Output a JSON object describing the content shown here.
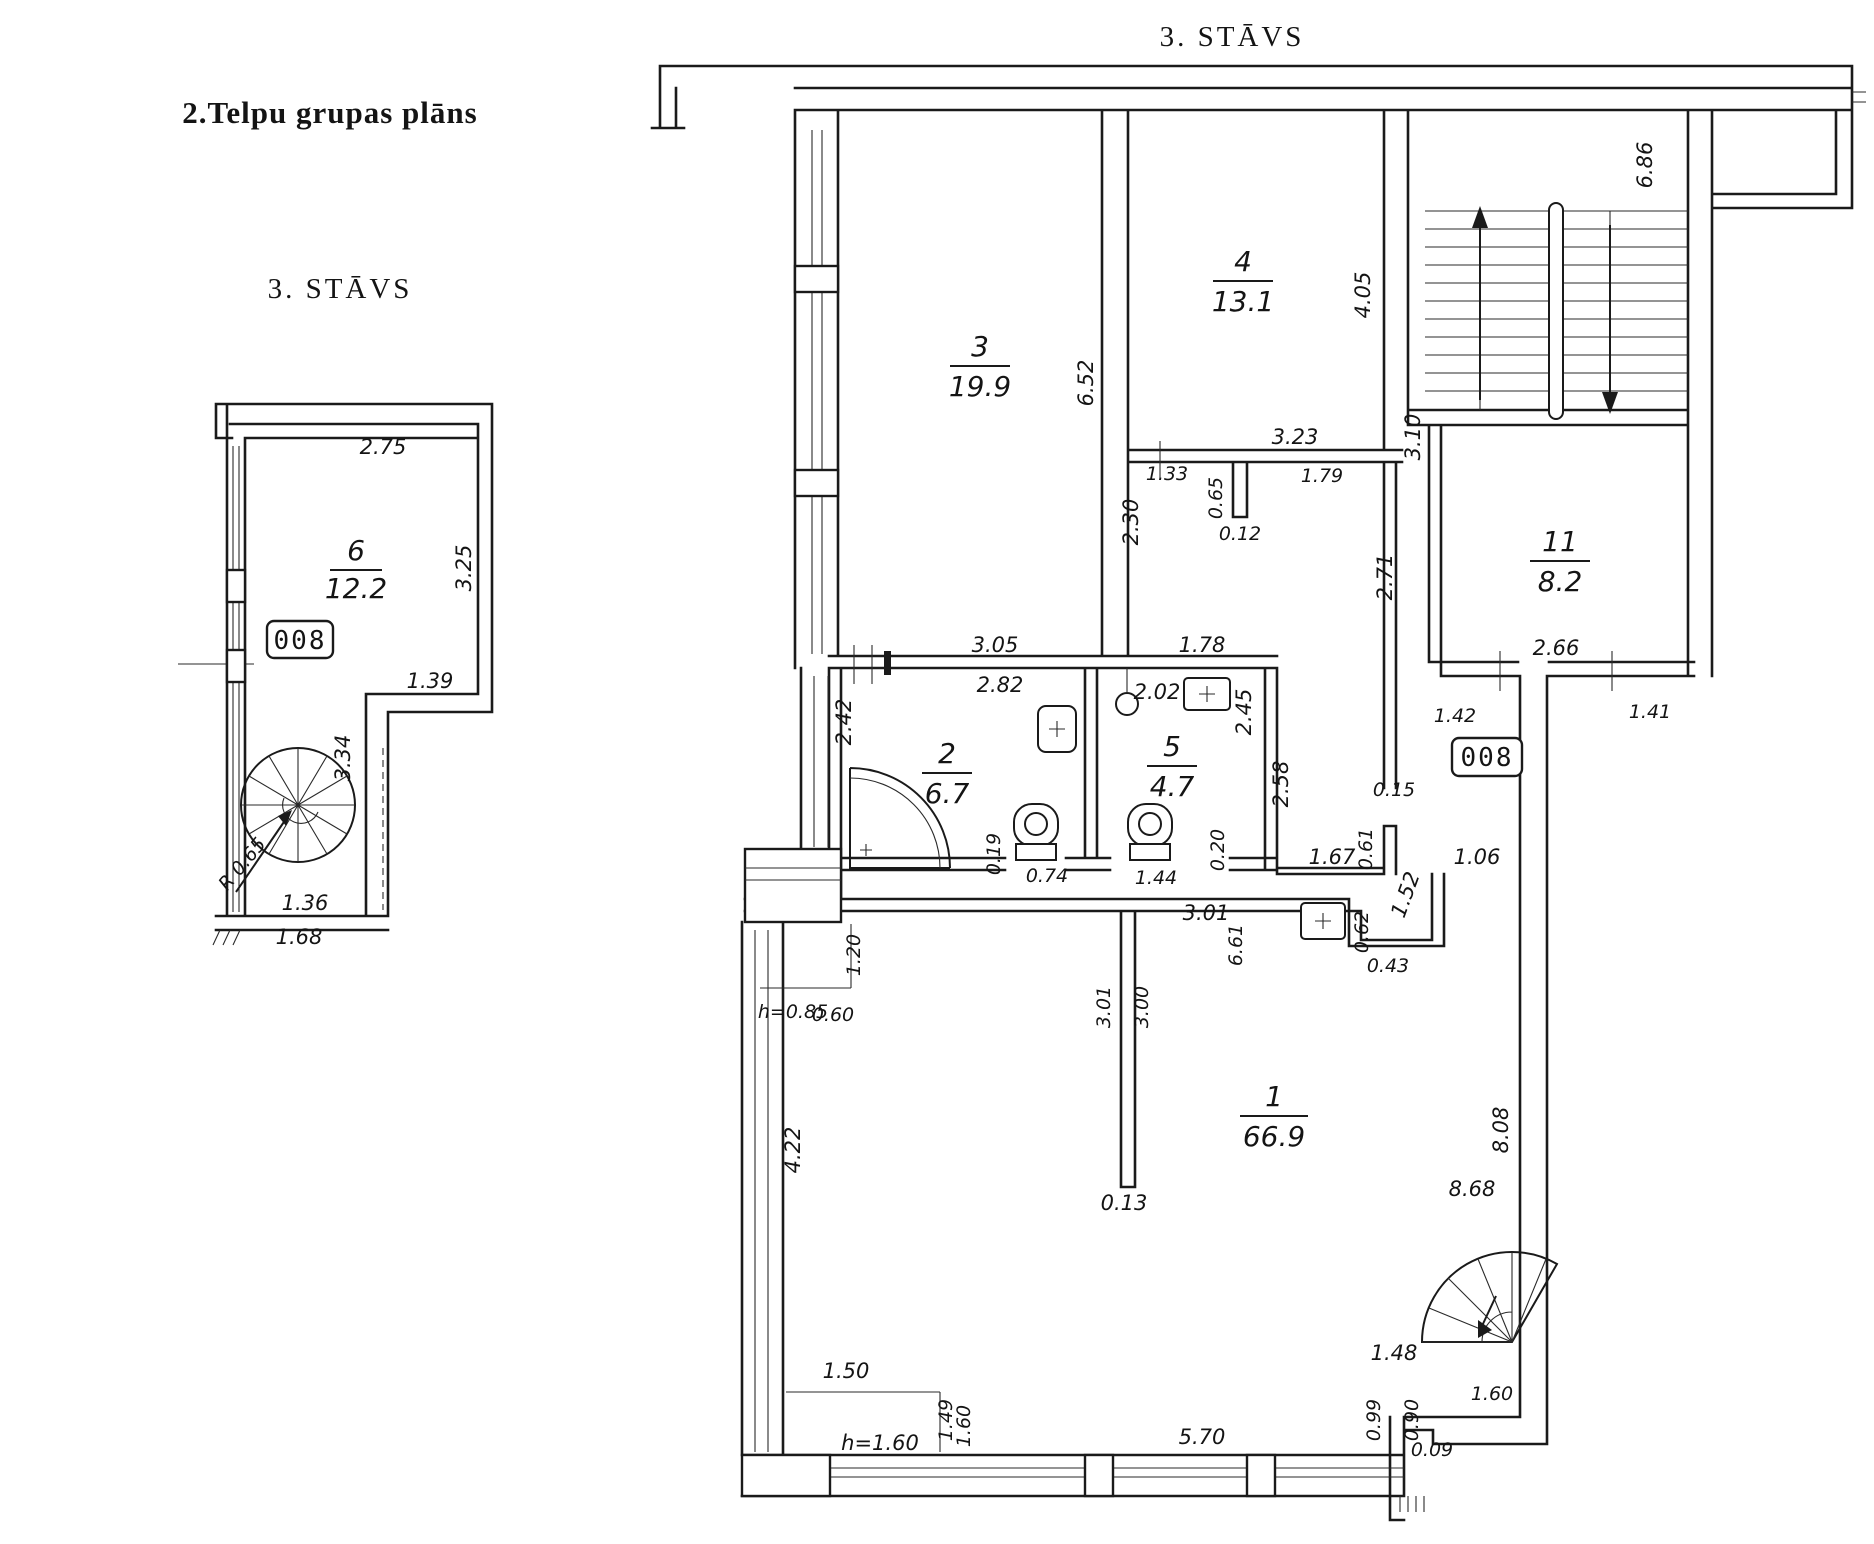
{
  "page_title": "2.Telpu grupas plāns",
  "left_plan": {
    "floor_label": "3. STĀVS",
    "unit_label": "008",
    "room": {
      "number": "6",
      "area": "12.2"
    },
    "dims": {
      "top_width": "2.75",
      "right_height": "3.25",
      "niche_width": "1.39",
      "stair_zone_height": "3.34",
      "stair_zone_width": "1.36",
      "bottom_width": "1.68",
      "stair_radius": "R 0.65"
    }
  },
  "main_plan": {
    "floor_label": "3. STĀVS",
    "unit_label": "008",
    "rooms": {
      "room1": {
        "number": "1",
        "area": "66.9"
      },
      "room2": {
        "number": "2",
        "area": "6.7"
      },
      "room3": {
        "number": "3",
        "area": "19.9"
      },
      "room4": {
        "number": "4",
        "area": "13.1"
      },
      "room5": {
        "number": "5",
        "area": "4.7"
      },
      "room11": {
        "number": "11",
        "area": "8.2"
      }
    },
    "dims": {
      "room3_height": "6.52",
      "room4_height": "4.05",
      "room4_width": "3.23",
      "stairwell_height": "6.86",
      "stairwell_width": "3.10",
      "lobby_seg1": "1.33",
      "lobby_notch_depth": "0.65",
      "lobby_seg2": "1.79",
      "lobby_notch_width": "0.12",
      "lobby_height": "2.30",
      "corridor11_height": "2.71",
      "room11_width": "2.66",
      "room11_left_offset": "1.42",
      "room11_right_offset": "1.41",
      "room2_top": "3.05",
      "room2_width": "2.82",
      "room5_top": "1.78",
      "room5_inner": "2.02",
      "room2_height": "2.42",
      "room5_height": "2.45",
      "room5_right": "2.58",
      "wc2_offset": "0.19",
      "wc2_door": "0.74",
      "wc5_door": "1.44",
      "wc5_offset": "0.20",
      "hall_seg1": "1.67",
      "stub_length": "0.61",
      "stub_width": "0.15",
      "hall_seg2": "1.06",
      "hall_drop": "1.52",
      "jog_depth": "0.62",
      "jog_width": "0.43",
      "room1_top": "3.01",
      "room1_vert": "6.61",
      "partition_left": "3.01",
      "partition_right": "3.00",
      "partition_thickness": "0.13",
      "niche_height": "1.20",
      "niche_sill": "h=0.85",
      "niche_sill2": "0.60",
      "room1_left_height": "4.22",
      "room1_right_height": "8.68",
      "shaft_height": "8.08",
      "bay_width": "1.50",
      "bay_height": "h=1.60",
      "bay_v1": "1.49",
      "bay_v2": "1.60",
      "bottom_window": "5.70",
      "exit_gap": "1.48",
      "exit_width": "1.60",
      "exit_v1": "0.99",
      "exit_v2": "0.90",
      "exit_offset": "0.09"
    }
  }
}
